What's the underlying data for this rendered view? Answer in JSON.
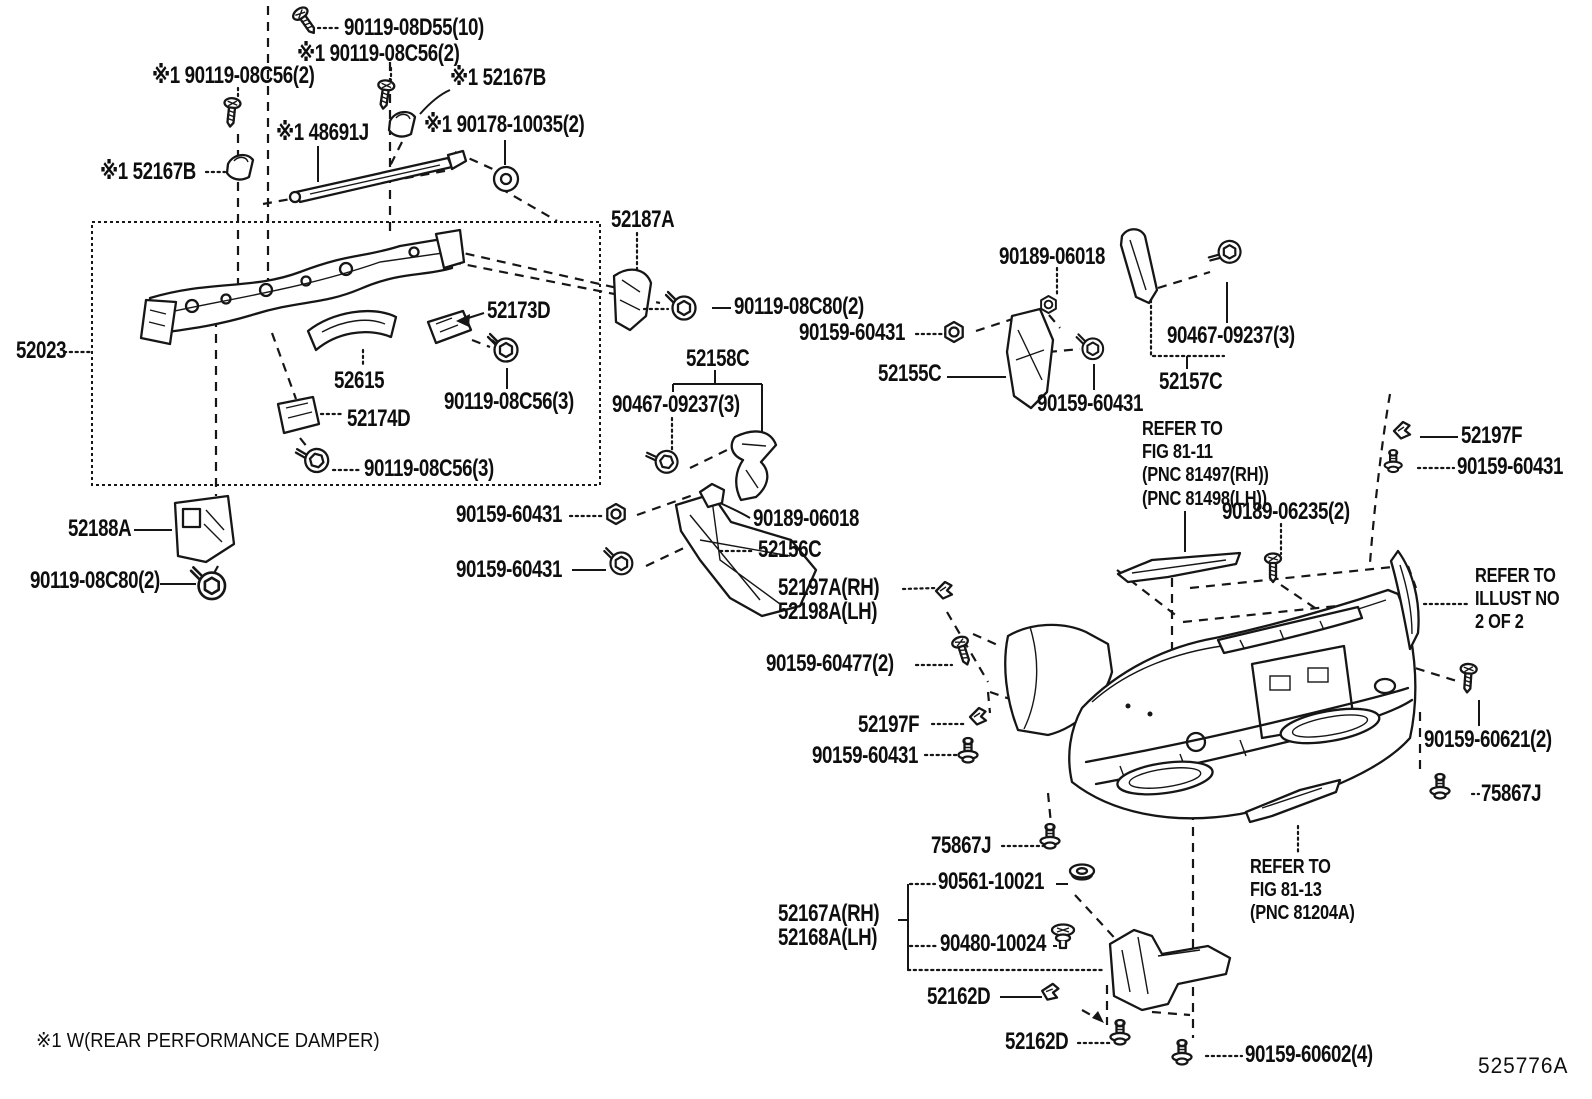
{
  "diagram": {
    "drawing_code": "525776A",
    "footnote": "※1 W(REAR PERFORMANCE DAMPER)",
    "labels": [
      {
        "text": "90119-08D55(10)",
        "x": 344,
        "y": 16,
        "style": "part"
      },
      {
        "text": "※1 90119-08C56(2)",
        "x": 297,
        "y": 42,
        "style": "part"
      },
      {
        "text": "※1 90119-08C56(2)",
        "x": 152,
        "y": 64,
        "style": "part"
      },
      {
        "text": "※1 52167B",
        "x": 450,
        "y": 66,
        "style": "part"
      },
      {
        "text": "※1 48691J",
        "x": 276,
        "y": 121,
        "style": "part"
      },
      {
        "text": "※1 90178-10035(2)",
        "x": 424,
        "y": 113,
        "style": "part"
      },
      {
        "text": "※1 52167B",
        "x": 100,
        "y": 160,
        "style": "part"
      },
      {
        "text": "52187A",
        "x": 611,
        "y": 208,
        "style": "part"
      },
      {
        "text": "90189-06018",
        "x": 999,
        "y": 245,
        "style": "part"
      },
      {
        "text": "90119-08C80(2)",
        "x": 734,
        "y": 295,
        "style": "part"
      },
      {
        "text": "90159-60431",
        "x": 799,
        "y": 321,
        "style": "part"
      },
      {
        "text": "52155C",
        "x": 878,
        "y": 362,
        "style": "part"
      },
      {
        "text": "90467-09237(3)",
        "x": 1167,
        "y": 324,
        "style": "part"
      },
      {
        "text": "52157C",
        "x": 1159,
        "y": 370,
        "style": "part"
      },
      {
        "text": "90159-60431",
        "x": 1037,
        "y": 392,
        "style": "part"
      },
      {
        "text": "52023",
        "x": 16,
        "y": 339,
        "style": "part"
      },
      {
        "text": "52173D",
        "x": 487,
        "y": 299,
        "style": "part"
      },
      {
        "text": "52615",
        "x": 334,
        "y": 369,
        "style": "part"
      },
      {
        "text": "90119-08C56(3)",
        "x": 444,
        "y": 390,
        "style": "part"
      },
      {
        "text": "52174D",
        "x": 347,
        "y": 407,
        "style": "part"
      },
      {
        "text": "90119-08C56(3)",
        "x": 364,
        "y": 457,
        "style": "part"
      },
      {
        "text": "52158C",
        "x": 686,
        "y": 347,
        "style": "part"
      },
      {
        "text": "90467-09237(3)",
        "x": 612,
        "y": 393,
        "style": "part"
      },
      {
        "text": "52188A",
        "x": 68,
        "y": 517,
        "style": "part"
      },
      {
        "text": "90119-08C80(2)",
        "x": 30,
        "y": 569,
        "style": "part"
      },
      {
        "text": "90159-60431",
        "x": 456,
        "y": 503,
        "style": "part"
      },
      {
        "text": "90189-06018",
        "x": 753,
        "y": 507,
        "style": "part"
      },
      {
        "text": "52156C",
        "x": 758,
        "y": 538,
        "style": "part"
      },
      {
        "text": "90159-60431",
        "x": 456,
        "y": 558,
        "style": "part"
      },
      {
        "text": "52197A(RH)",
        "x": 778,
        "y": 576,
        "style": "part"
      },
      {
        "text": "52198A(LH)",
        "x": 778,
        "y": 600,
        "style": "part"
      },
      {
        "text": "90159-60477(2)",
        "x": 766,
        "y": 652,
        "style": "part"
      },
      {
        "text": "52197F",
        "x": 858,
        "y": 713,
        "style": "part"
      },
      {
        "text": "90159-60431",
        "x": 812,
        "y": 744,
        "style": "part"
      },
      {
        "text": "52197F",
        "x": 1461,
        "y": 424,
        "style": "part"
      },
      {
        "text": "90159-60431",
        "x": 1457,
        "y": 455,
        "style": "part"
      },
      {
        "text": "90189-06235(2)",
        "x": 1222,
        "y": 500,
        "style": "part"
      },
      {
        "text": "90159-60621(2)",
        "x": 1424,
        "y": 728,
        "style": "part"
      },
      {
        "text": "75867J",
        "x": 1481,
        "y": 782,
        "style": "part"
      },
      {
        "text": "75867J",
        "x": 931,
        "y": 834,
        "style": "part"
      },
      {
        "text": "90561-10021",
        "x": 938,
        "y": 870,
        "style": "part"
      },
      {
        "text": "90480-10024",
        "x": 940,
        "y": 932,
        "style": "part"
      },
      {
        "text": "52167A(RH)",
        "x": 778,
        "y": 902,
        "style": "part"
      },
      {
        "text": "52168A(LH)",
        "x": 778,
        "y": 926,
        "style": "part"
      },
      {
        "text": "52162D",
        "x": 927,
        "y": 985,
        "style": "part"
      },
      {
        "text": "52162D",
        "x": 1005,
        "y": 1030,
        "style": "part"
      },
      {
        "text": "90159-60602(4)",
        "x": 1245,
        "y": 1043,
        "style": "part"
      },
      {
        "text": "REFER TO\nFIG 81-11\n(PNC 81497(RH))\n(PNC 81498(LH))",
        "x": 1142,
        "y": 418,
        "style": "note"
      },
      {
        "text": "REFER TO\nILLUST NO\n2 OF 2",
        "x": 1475,
        "y": 565,
        "style": "note"
      },
      {
        "text": "REFER TO\nFIG 81-13\n(PNC 81204A)",
        "x": 1250,
        "y": 856,
        "style": "note"
      },
      {
        "text": "※1 W(REAR PERFORMANCE DAMPER)",
        "x": 36,
        "y": 1028,
        "style": "footnote"
      },
      {
        "text": "525776A",
        "x": 1478,
        "y": 1053,
        "style": "code"
      }
    ]
  }
}
